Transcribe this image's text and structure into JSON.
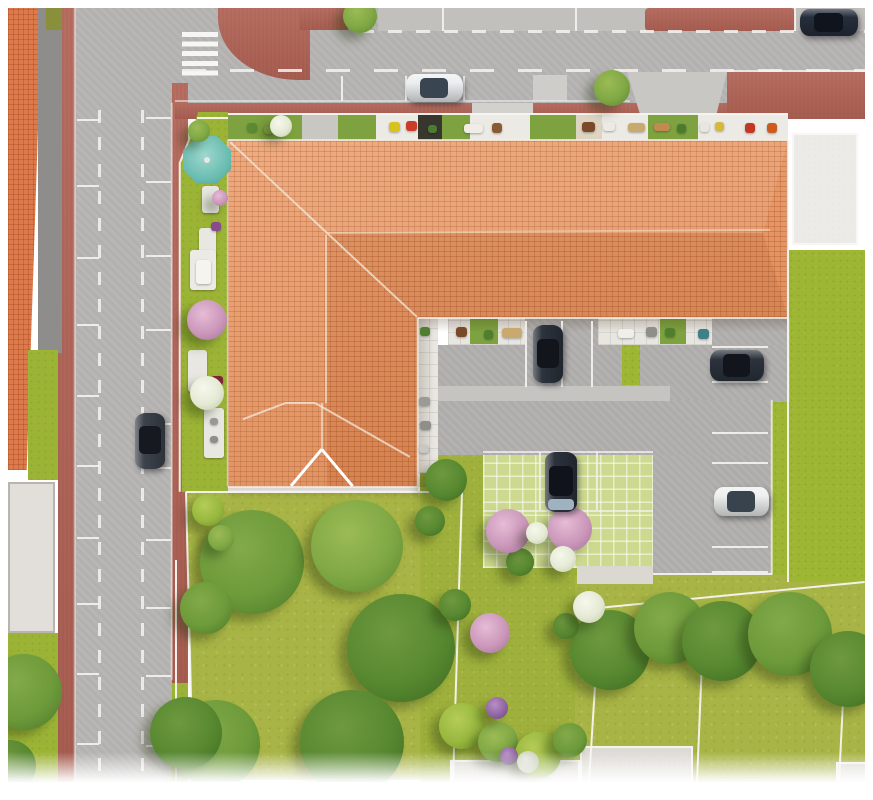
{
  "scene": {
    "type": "aerial-architectural-site-plan",
    "subject": "residential building with terracotta hip roof on a street corner, with courtyard parking, private terraces and landscaped gardens",
    "visible_text": ""
  },
  "palette": {
    "page_bg": "#ffffff",
    "road": "#b7b5b3",
    "road_marking": "#f4f3f1",
    "sidewalk_red": "#b16355",
    "roof_tile": "#e78f58",
    "roof_ridge": "#f3e9da",
    "lawn": "#a8b445",
    "lawn_bright": "#9db634",
    "grass_paver": "#cdd98f",
    "concrete_pad": "#e2dfda",
    "white_gravel": "#edebe7",
    "tree_green": "#6d9a3a",
    "blossom_pink": "#cb97ba",
    "blossom_white": "#e4e9d3",
    "umbrella_teal": "#6cbdb2",
    "car_white": "#eceff1",
    "car_dark_navy": "#262e3c",
    "car_gray": "#3d434b"
  },
  "segment_colors": {
    "grass": "#7da23f",
    "paver": "#eceae5",
    "dark": "#37372f",
    "beige": "#ddd5c2",
    "concrete": "#c9c7c1"
  },
  "tree_colors": {
    "g1": [
      "#83aa4a",
      "#6d9a3a",
      "#4a7827"
    ],
    "g2": [
      "#6f9940",
      "#578830",
      "#3c6a1f"
    ],
    "g3": [
      "#9cbb55",
      "#7fa844",
      "#5c8530"
    ],
    "sh": [
      "#b5cc58",
      "#98b83e",
      "#74942c"
    ],
    "pk": [
      "#e6bcd6",
      "#cb97ba",
      "#a4719a"
    ],
    "wh": [
      "#f6f8ec",
      "#e4e9d3",
      "#bcc8a6"
    ],
    "pu": [
      "#b78fc4",
      "#9065a2",
      "#684083"
    ],
    "sg": [
      "#e4e7da",
      "#ccd1bd",
      "#a6ac94"
    ]
  },
  "terrace_north_segments": [
    [
      228,
      74,
      "grass"
    ],
    [
      302,
      36,
      "concrete"
    ],
    [
      338,
      38,
      "grass"
    ],
    [
      376,
      42,
      "paver"
    ],
    [
      418,
      24,
      "dark"
    ],
    [
      442,
      28,
      "grass"
    ],
    [
      470,
      60,
      "paver"
    ],
    [
      530,
      46,
      "grass"
    ],
    [
      576,
      26,
      "beige"
    ],
    [
      602,
      46,
      "paver"
    ],
    [
      648,
      50,
      "grass"
    ],
    [
      698,
      90,
      "paver"
    ]
  ],
  "terrace_court_segments": [
    [
      470,
      28,
      "grass"
    ],
    [
      660,
      26,
      "grass"
    ]
  ],
  "line_groups": {
    "road-marking": {
      "color": "#f4f3f1",
      "width": 2,
      "opacity": 0.9,
      "items": [
        [
          75,
          8,
          75,
          782,
          1.5,
          0.55
        ],
        [
          172,
          103,
          172,
          680,
          1.5,
          0.5
        ],
        [
          175,
          101,
          630,
          101,
          1.5,
          0.55
        ],
        [
          727,
          71,
          865,
          71,
          2,
          0.8
        ],
        [
          653,
          574,
          772,
          574,
          2,
          0.9
        ],
        [
          483,
          452,
          653,
          452,
          1.8,
          0.75
        ],
        [
          483,
          511,
          653,
          511,
          1.8,
          0.7
        ],
        [
          540,
          452,
          540,
          510,
          1.8,
          0.8
        ],
        [
          597,
          452,
          597,
          510,
          1.8,
          0.8
        ],
        [
          77,
          120,
          99,
          120
        ],
        [
          77,
          186,
          99,
          186
        ],
        [
          77,
          258,
          99,
          258
        ],
        [
          77,
          325,
          99,
          325
        ],
        [
          77,
          396,
          99,
          396
        ],
        [
          77,
          466,
          99,
          466
        ],
        [
          77,
          538,
          99,
          538
        ],
        [
          77,
          604,
          99,
          604
        ],
        [
          77,
          674,
          99,
          674
        ],
        [
          77,
          744,
          99,
          744
        ],
        [
          146,
          118,
          171,
          118
        ],
        [
          146,
          182,
          171,
          182
        ],
        [
          146,
          256,
          171,
          256
        ],
        [
          146,
          330,
          171,
          330
        ],
        [
          146,
          424,
          171,
          424
        ],
        [
          146,
          468,
          171,
          468
        ],
        [
          146,
          540,
          171,
          540
        ],
        [
          146,
          608,
          171,
          608
        ],
        [
          146,
          676,
          171,
          676
        ],
        [
          146,
          746,
          171,
          746
        ],
        [
          443,
          8,
          443,
          31
        ],
        [
          576,
          8,
          576,
          31
        ],
        [
          795,
          8,
          795,
          31
        ],
        [
          342,
          76,
          342,
          101
        ],
        [
          406,
          76,
          406,
          101
        ],
        [
          464,
          76,
          464,
          101
        ],
        [
          526,
          321,
          526,
          387
        ],
        [
          562,
          321,
          562,
          387
        ],
        [
          592,
          321,
          592,
          387
        ],
        [
          712,
          347,
          768,
          347
        ],
        [
          712,
          382,
          768,
          382
        ],
        [
          712,
          433,
          768,
          433
        ],
        [
          712,
          463,
          768,
          463
        ],
        [
          712,
          547,
          768,
          547
        ],
        [
          712,
          572,
          768,
          572
        ]
      ]
    },
    "fence": {
      "color": "#f7f6f2",
      "width": 2,
      "opacity": 0.95,
      "items": [
        [
          186,
          492,
          462,
          492
        ],
        [
          186,
          492,
          193,
          780
        ],
        [
          462,
          492,
          453,
          780
        ],
        [
          600,
          606,
          589,
          782
        ],
        [
          704,
          612,
          697,
          782
        ],
        [
          846,
          640,
          839,
          782
        ],
        [
          598,
          608,
          865,
          582
        ],
        [
          788,
          250,
          788,
          582
        ],
        [
          176,
          560,
          176,
          782
        ],
        [
          228,
          114,
          788,
          114,
          1.5
        ],
        [
          180,
          162,
          180,
          492,
          1.5
        ],
        [
          180,
          162,
          197,
          120,
          1.5
        ],
        [
          197,
          118,
          228,
          118,
          1.5
        ],
        [
          772,
          400,
          772,
          575,
          1.5,
          0.7
        ]
      ]
    },
    "roof-eave": {
      "color": "#f5efe5",
      "width": 1.5,
      "opacity": 0.8,
      "items": [
        [
          228,
          140,
          788,
          140
        ],
        [
          788,
          140,
          788,
          318
        ],
        [
          418,
          318,
          788,
          318
        ],
        [
          418,
          318,
          418,
          487
        ],
        [
          228,
          487,
          418,
          487
        ],
        [
          228,
          140,
          228,
          487,
          1.5,
          0.5
        ]
      ]
    },
    "roof-ridge": {
      "color": "#f3e9da",
      "width": 2.2,
      "opacity": 0.75,
      "items": [
        [
          230,
          142,
          327,
          233
        ],
        [
          327,
          233,
          770,
          230,
          2,
          0.5
        ],
        [
          327,
          233,
          417,
          317
        ],
        [
          326,
          235,
          326,
          403,
          2,
          0.6
        ],
        [
          285,
          403,
          315,
          403
        ],
        [
          285,
          403,
          243,
          419
        ],
        [
          315,
          403,
          410,
          457
        ],
        [
          322,
          403,
          322,
          449,
          2,
          0.6
        ]
      ]
    },
    "canopy-edge": {
      "color": "#ffffff",
      "width": 2.6,
      "opacity": 1,
      "items": [
        [
          322,
          449,
          291,
          486
        ],
        [
          322,
          449,
          353,
          486
        ]
      ]
    }
  },
  "furniture_groups": {
    "terrace-furniture-north": [
      [
        247,
        123,
        10,
        9,
        "#5d8a33"
      ],
      [
        264,
        126,
        9,
        8,
        "#86a844"
      ],
      [
        389,
        122,
        11,
        10,
        "#d9c21c"
      ],
      [
        406,
        121,
        11,
        10,
        "#cc3a28"
      ],
      [
        428,
        125,
        9,
        8,
        "#4c7a2e"
      ],
      [
        464,
        124,
        19,
        9,
        "#f0ede7"
      ],
      [
        492,
        123,
        10,
        10,
        "#8a5a30"
      ],
      [
        582,
        122,
        13,
        10,
        "#7a4a28"
      ],
      [
        603,
        122,
        12,
        9,
        "#eceae4"
      ],
      [
        628,
        123,
        17,
        9,
        "#c9a96e"
      ],
      [
        654,
        123,
        16,
        8,
        "#c08a50"
      ],
      [
        677,
        124,
        9,
        9,
        "#4c7a2e"
      ],
      [
        700,
        123,
        9,
        9,
        "#e8e6e0"
      ],
      [
        715,
        122,
        9,
        9,
        "#d8b83a"
      ],
      [
        745,
        123,
        10,
        10,
        "#c23822"
      ],
      [
        767,
        123,
        10,
        10,
        "#cc5a1f"
      ]
    ],
    "terrace-furniture-court": [
      [
        456,
        327,
        11,
        10,
        "#7a4a28"
      ],
      [
        484,
        330,
        9,
        9,
        "#4e7e2e"
      ],
      [
        502,
        328,
        20,
        10,
        "#c9a96e"
      ],
      [
        618,
        329,
        16,
        9,
        "#f0eee8"
      ],
      [
        646,
        327,
        11,
        10,
        "#8e8e8a"
      ],
      [
        665,
        328,
        10,
        9,
        "#4e7e2e"
      ],
      [
        698,
        329,
        11,
        10,
        "#3f7f8a"
      ]
    ],
    "terrace-furniture-west-wing": [
      [
        420,
        327,
        10,
        9,
        "#4e7e2e"
      ],
      [
        419,
        397,
        11,
        9,
        "#9a9a96"
      ],
      [
        420,
        421,
        11,
        9,
        "#8e8e8a"
      ],
      [
        419,
        445,
        10,
        8,
        "#c9c7c1"
      ]
    ],
    "garden-furniture": [
      [
        202,
        186,
        17,
        27,
        "#e9e7e2"
      ],
      [
        199,
        228,
        17,
        31,
        "#e9e7e2"
      ],
      [
        190,
        250,
        26,
        40,
        "#eceae5"
      ],
      [
        188,
        350,
        19,
        42,
        "#e9e7e2"
      ],
      [
        204,
        408,
        20,
        50,
        "#e9e7e2"
      ],
      [
        196,
        260,
        15,
        24,
        "#f6f4ee"
      ],
      [
        211,
        222,
        10,
        9,
        "#8a4a8e"
      ],
      [
        211,
        376,
        12,
        9,
        "#7e2436"
      ],
      [
        210,
        418,
        8,
        7,
        "#9a9a96"
      ],
      [
        210,
        436,
        8,
        7,
        "#8e8e8a"
      ],
      [
        197,
        170,
        18,
        11,
        "#f0eee9"
      ]
    ]
  },
  "trees": [
    [
      "lawn-tree-1",
      252,
      562,
      52,
      "g1"
    ],
    [
      "lawn-tree-2",
      357,
      546,
      46,
      "g3"
    ],
    [
      "lawn-tree-3",
      401,
      648,
      54,
      "g2"
    ],
    [
      "lawn-tree-4",
      216,
      744,
      44,
      "g1"
    ],
    [
      "lawn-tree-5",
      352,
      742,
      52,
      "g2"
    ],
    [
      "roadside-tree-1",
      206,
      608,
      26,
      "g1"
    ],
    [
      "roadside-tree-2",
      186,
      733,
      36,
      "g2"
    ],
    [
      "corner-tree-1",
      24,
      692,
      38,
      "g1"
    ],
    [
      "corner-tree-2",
      10,
      766,
      26,
      "g2"
    ],
    [
      "se-tree-1",
      610,
      650,
      40,
      "g2"
    ],
    [
      "se-tree-2",
      670,
      628,
      36,
      "g1"
    ],
    [
      "se-tree-3",
      722,
      641,
      40,
      "g2"
    ],
    [
      "se-tree-4",
      790,
      634,
      42,
      "g1"
    ],
    [
      "se-tree-5",
      848,
      669,
      38,
      "g2"
    ],
    [
      "street-tree-1",
      360,
      16,
      17,
      "g3"
    ],
    [
      "street-tree-2",
      612,
      88,
      18,
      "g3"
    ],
    [
      "court-bush-1",
      446,
      480,
      21,
      "g2"
    ],
    [
      "court-bush-2",
      430,
      521,
      15,
      "g2"
    ],
    [
      "court-bush-3",
      455,
      605,
      16,
      "g2"
    ],
    [
      "court-bush-4",
      520,
      562,
      14,
      "g2"
    ],
    [
      "court-bush-5",
      566,
      626,
      13,
      "g2"
    ],
    [
      "shrub-1",
      462,
      726,
      23,
      "sh"
    ],
    [
      "shrub-2",
      498,
      742,
      20,
      "g3"
    ],
    [
      "shrub-3",
      538,
      755,
      23,
      "sh"
    ],
    [
      "shrub-4",
      570,
      740,
      17,
      "g1"
    ],
    [
      "garden-bush-1",
      199,
      131,
      11,
      "g3"
    ],
    [
      "lawn-shrub-1",
      208,
      510,
      16,
      "sh"
    ],
    [
      "lawn-shrub-2",
      221,
      538,
      13,
      "g3"
    ],
    [
      "blossom-pink-1",
      207,
      320,
      20,
      "pk"
    ],
    [
      "blossom-pink-2",
      508,
      531,
      22,
      "pk"
    ],
    [
      "blossom-pink-3",
      570,
      529,
      22,
      "pk"
    ],
    [
      "blossom-pink-4",
      490,
      633,
      20,
      "pk"
    ],
    [
      "blossom-pink-5",
      220,
      198,
      8,
      "pk"
    ],
    [
      "blossom-white-1",
      207,
      393,
      17,
      "wh"
    ],
    [
      "blossom-white-2",
      537,
      533,
      11,
      "wh"
    ],
    [
      "blossom-white-3",
      563,
      559,
      13,
      "wh"
    ],
    [
      "blossom-white-4",
      589,
      607,
      16,
      "wh"
    ],
    [
      "blossom-white-5",
      281,
      126,
      11,
      "wh"
    ],
    [
      "blossom-purple-1",
      497,
      708,
      11,
      "pu"
    ],
    [
      "blossom-purple-2",
      509,
      756,
      9,
      "pu"
    ],
    [
      "sage-bush-1",
      528,
      762,
      11,
      "sg"
    ]
  ],
  "cars": [
    {
      "name": "car-white-north-street",
      "x": 406,
      "y": 74,
      "w": 57,
      "h": 28,
      "dir": "h",
      "body": "#eceff1",
      "glass": "#3a4552"
    },
    {
      "name": "car-dark-north-street",
      "x": 800,
      "y": 9,
      "w": 58,
      "h": 27,
      "dir": "h",
      "body": "#262e3c",
      "glass": "#10151d"
    },
    {
      "name": "car-gray-west-street",
      "x": 135,
      "y": 413,
      "w": 30,
      "h": 56,
      "dir": "v",
      "body": "#3d434b",
      "glass": "#161a20"
    },
    {
      "name": "car-dark-courtyard",
      "x": 533,
      "y": 325,
      "w": 30,
      "h": 58,
      "dir": "v",
      "body": "#2c333d",
      "glass": "#12161c"
    },
    {
      "name": "car-dark-grass-pavers",
      "x": 545,
      "y": 452,
      "w": 32,
      "h": 60,
      "dir": "v",
      "body": "#2b323c",
      "glass": "#10141a",
      "hood": "#9fb2bf"
    },
    {
      "name": "car-dark-east-lot",
      "x": 710,
      "y": 350,
      "w": 54,
      "h": 31,
      "dir": "h",
      "body": "#2c333d",
      "glass": "#12161c"
    },
    {
      "name": "car-white-east-lot",
      "x": 714,
      "y": 487,
      "w": 55,
      "h": 29,
      "dir": "h",
      "body": "#eef0f0",
      "glass": "#39434e"
    }
  ]
}
